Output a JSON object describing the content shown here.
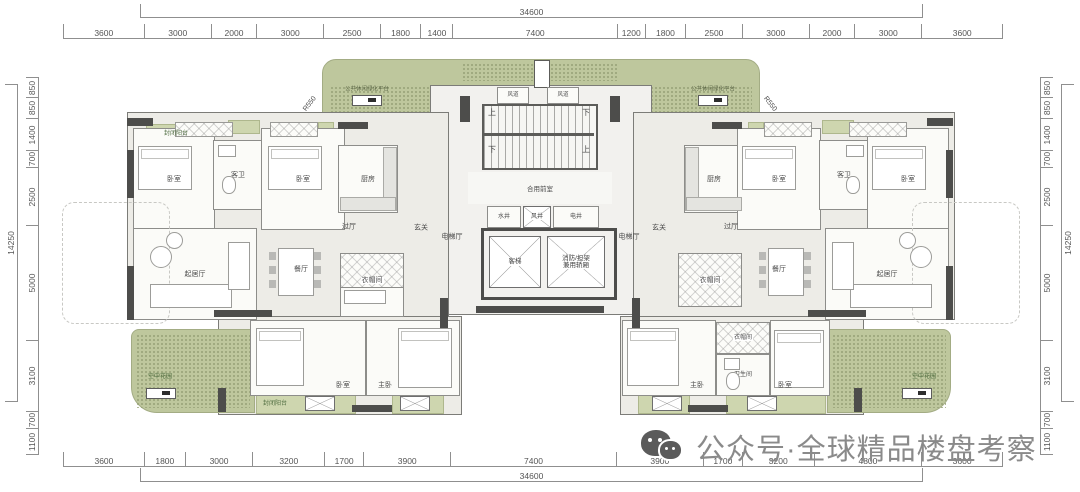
{
  "watermark": {
    "text": "公众号·全球精品楼盘考察"
  },
  "dims": {
    "top_total": "34600",
    "bottom_total": "34600",
    "left_total": "14250",
    "right_total": "14250",
    "top": [
      "3600",
      "3000",
      "2000",
      "3000",
      "2500",
      "1800",
      "1400",
      "7400",
      "1200",
      "1800",
      "2500",
      "3000",
      "2000",
      "3000",
      "3600"
    ],
    "bottom": [
      "3600",
      "1800",
      "3000",
      "3200",
      "1700",
      "3900",
      "7400",
      "3900",
      "1700",
      "3200",
      "4800",
      "3600"
    ],
    "left": [
      "850",
      "850",
      "1400",
      "700",
      "2500",
      "5000",
      "3100",
      "700",
      "1100"
    ],
    "right": [
      "850",
      "850",
      "1400",
      "700",
      "2500",
      "5000",
      "3100",
      "700",
      "1100"
    ]
  },
  "platform": {
    "label_left": "公共休闲绿化平台",
    "label_right": "公共休闲绿化平台",
    "r550_left": "R550",
    "r550_right": "R550"
  },
  "core": {
    "duct_left": "风道",
    "duct_right": "风道",
    "up1": "上",
    "down1": "下",
    "down2": "下",
    "up2": "上",
    "front_room": "合用前室",
    "shaft_water": "水井",
    "shaft_air": "风井",
    "shaft_elec": "电井",
    "lift_passenger": "客梯",
    "lift_fire_line1": "消防/担架",
    "lift_fire_line2": "兼用轿厢",
    "hall_left": "电梯厅",
    "hall_right": "电梯厅"
  },
  "left": {
    "balcony_top": "封闭阳台",
    "bedroom1": "卧室",
    "guest_bath": "客卫",
    "bedroom2": "卧室",
    "kitchen": "厨房",
    "hallway": "过厅",
    "foyer": "玄关",
    "living": "起居厅",
    "dining": "餐厅",
    "closet": "衣帽间",
    "bedroom3": "卧室",
    "master": "主卧",
    "balcony_bottom": "封闭阳台",
    "garden": "空中花园"
  },
  "right": {
    "kitchen": "厨房",
    "bedroom1": "卧室",
    "guest_bath": "客卫",
    "bedroom2": "卧室",
    "foyer": "玄关",
    "hallway": "过厅",
    "closet_mid": "衣帽间",
    "dining": "餐厅",
    "living": "起居厅",
    "closet_low": "衣帽间",
    "bath": "卫生间",
    "master": "主卧",
    "bedroom3": "卧室",
    "garden": "空中花园"
  },
  "colors": {
    "platform_green": "#bec79d",
    "balcony_green": "#ced6af",
    "wall_dark": "#4d4d4b",
    "watermark_gray": "#8a8a8a"
  }
}
